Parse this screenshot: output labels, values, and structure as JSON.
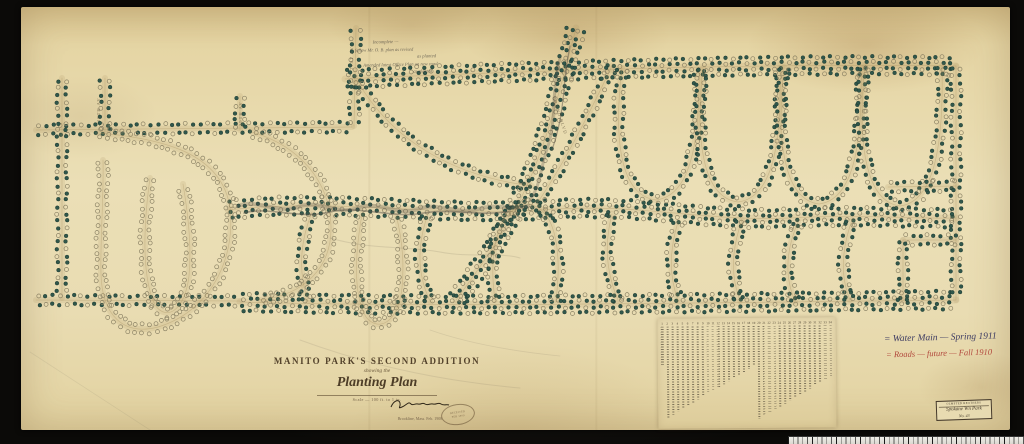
{
  "palette": {
    "paper": "#ebdfb6",
    "background": "#14120f",
    "ink": "#4d3d27",
    "road_line": "#a8905f",
    "tree_solid": "#30574b",
    "tree_rim": "#16312a",
    "tree_open": "#8a8164",
    "pencil": "#5c564a",
    "red_ink": "#b1463b",
    "blue_ink": "#3e3c63"
  },
  "title_block": {
    "line1": "MANITO PARK'S SECOND ADDITION",
    "line2": "showing the",
    "line3": "Planting Plan",
    "scale_note": "Scale — 100 ft. to 1 in.",
    "signature_sub": "Brookline, Mass. Feb. 1908"
  },
  "stamp": {
    "line1": "RECEIVED",
    "line2": "FEB 1909"
  },
  "annotations": {
    "top_pencil": [
      "Incomplete —",
      "follow Mr. O. B. plan as revised",
      "as planted",
      "Amended latest Office Plan on new road",
      "as planted"
    ]
  },
  "notes_right": {
    "line1": "= Water Main — Spring 1911",
    "line2": "= Roads — future — Fall 1910"
  },
  "corner_label": {
    "header": "OLMSTED BROTHERS",
    "line1": "Spokane Wn Park",
    "line2": "No. 43"
  },
  "street_labels": [
    "18TH AV",
    "19TH AV",
    "21ST AV",
    "GRAND BLVD"
  ],
  "legend": {
    "numbers": [
      "1",
      "2",
      "3",
      "4",
      "5",
      "6",
      "7",
      "8",
      "9",
      "10",
      "11",
      "12",
      "13",
      "14",
      "15",
      "16",
      "17",
      "18",
      "19",
      "20",
      "21",
      "22",
      "23",
      "24",
      "25",
      "26",
      "27",
      "28",
      "29",
      "30",
      "31",
      "32",
      "33",
      "34"
    ]
  },
  "map": {
    "roads": [
      {
        "name": "top-avenue",
        "style": "boulevard",
        "d": "M 345 79 C 520 71 760 63 956 66"
      },
      {
        "name": "upper-left-avenue",
        "style": "planted",
        "d": "M 36 130 L 352 127"
      },
      {
        "name": "west-street",
        "style": "planted",
        "d": "M 62 78 L 62 298"
      },
      {
        "name": "west-street-2",
        "style": "planted",
        "d": "M 105 78 L 105 131"
      },
      {
        "name": "short-street",
        "style": "planted",
        "d": "M 240 96 L 240 130"
      },
      {
        "name": "north-street",
        "style": "planted",
        "d": "M 356 28 L 354 126"
      },
      {
        "name": "lower-left-street",
        "style": "planted",
        "d": "M 36 300 L 240 301"
      },
      {
        "name": "bottom-avenue",
        "style": "boulevard",
        "d": "M 240 302 C 450 308 750 302 956 300"
      },
      {
        "name": "east-street",
        "style": "planted",
        "d": "M 956 66 L 956 300"
      },
      {
        "name": "central-avenue",
        "style": "boulevard",
        "d": "M 228 210 C 330 198 430 216 540 210 C 640 202 700 222 790 218 C 860 214 912 219 956 218"
      },
      {
        "name": "grand-boulevard",
        "style": "boulevard",
        "d": "M 576 28 C 560 90 545 150 522 196 C 505 232 480 268 456 300"
      },
      {
        "name": "diagonal-branch",
        "style": "planted",
        "d": "M 612 66 C 590 112 565 162 538 202"
      },
      {
        "name": "curved-drive",
        "style": "planted",
        "d": "M 358 82 C 392 140 452 176 532 186"
      },
      {
        "name": "loop-drive-1",
        "style": "planted",
        "d": "M 622 68 C 612 150 624 196 656 200 C 688 196 700 150 699 70"
      },
      {
        "name": "loop-drive-2",
        "style": "planted",
        "d": "M 703 68 C 694 150 706 198 738 202 C 770 198 782 152 780 68"
      },
      {
        "name": "loop-drive-3",
        "style": "planted",
        "d": "M 784 67 C 775 150 787 200 819 204 C 851 200 863 152 861 67"
      },
      {
        "name": "loop-drive-4",
        "style": "planted",
        "d": "M 865 66 C 856 150 868 202 900 206 C 932 202 944 152 942 66"
      },
      {
        "name": "south-loop",
        "style": "planted",
        "d": "M 495 300 C 488 250 498 208 528 204 C 556 208 562 252 556 300"
      },
      {
        "name": "south-drive-1",
        "style": "planted",
        "d": "M 612 214 C 604 244 606 272 618 300"
      },
      {
        "name": "south-drive-2",
        "style": "planted",
        "d": "M 678 222 C 670 248 668 274 678 300"
      },
      {
        "name": "south-drive-3",
        "style": "planted",
        "d": "M 742 220 C 732 248 730 274 740 301"
      },
      {
        "name": "south-drive-4",
        "style": "planted",
        "d": "M 798 222 C 786 250 784 276 795 301"
      },
      {
        "name": "south-drive-5",
        "style": "planted",
        "d": "M 852 220 C 842 248 840 276 850 300"
      },
      {
        "name": "grid-street-v",
        "style": "planted",
        "d": "M 903 240 L 903 300"
      },
      {
        "name": "grid-street-h1",
        "style": "planted",
        "d": "M 903 240 L 956 240"
      },
      {
        "name": "grid-street-h2",
        "style": "planted",
        "d": "M 888 187 L 956 186"
      },
      {
        "name": "planted-drive-1",
        "style": "planted",
        "d": "M 428 214 C 418 242 416 272 430 301"
      },
      {
        "name": "planted-drive-2",
        "style": "planted",
        "d": "M 312 212 C 300 242 298 272 308 301"
      },
      {
        "name": "serpentine-loop",
        "style": "open",
        "d": "M 98 133 C 160 138 222 152 230 208 C 236 262 208 312 158 327 C 124 336 102 316 101 274 C 100 240 104 196 103 160"
      },
      {
        "name": "hairpin-loop",
        "style": "open",
        "d": "M 150 178 C 143 228 142 278 155 305 C 167 322 185 310 189 276 C 192 242 187 208 183 184"
      },
      {
        "name": "park-oval",
        "style": "open",
        "d": "M 252 132 C 300 146 330 182 331 226 C 332 268 304 295 260 300"
      },
      {
        "name": "south-hairpin",
        "style": "open",
        "d": "M 362 214 C 355 254 353 294 366 317 C 378 332 398 324 402 288 C 405 256 400 230 396 215"
      }
    ],
    "scribbles": [
      {
        "d": "M 238 206 C 258 198 278 215 298 207 C 318 199 338 216 358 208 C 378 200 398 217 418 209 C 438 201 458 216 478 209 C 498 203 514 211 528 206",
        "w": 4,
        "o": 0.28
      },
      {
        "d": "M 244 213 C 270 206 300 220 330 212 C 360 205 392 219 424 213 C 452 208 480 217 510 211",
        "w": 1.6,
        "o": 0.5
      },
      {
        "d": "M 560 58 C 550 96 558 120 546 152 C 540 172 540 186 530 200",
        "w": 3,
        "o": 0.3
      },
      {
        "d": "M 570 46 C 562 84 566 110 552 150",
        "w": 1.2,
        "o": 0.5
      },
      {
        "d": "M 330 238 C 370 250 410 246 440 252 C 470 258 500 252 520 258",
        "w": 1,
        "o": 0.15
      },
      {
        "d": "M 300 340 C 360 362 430 380 520 388",
        "w": 1,
        "o": 0.12
      },
      {
        "d": "M 430 330 C 470 344 520 352 560 356",
        "w": 0.8,
        "o": 0.12
      },
      {
        "d": "M 30 352 L 150 430",
        "w": 0.8,
        "o": 0.1
      }
    ]
  }
}
